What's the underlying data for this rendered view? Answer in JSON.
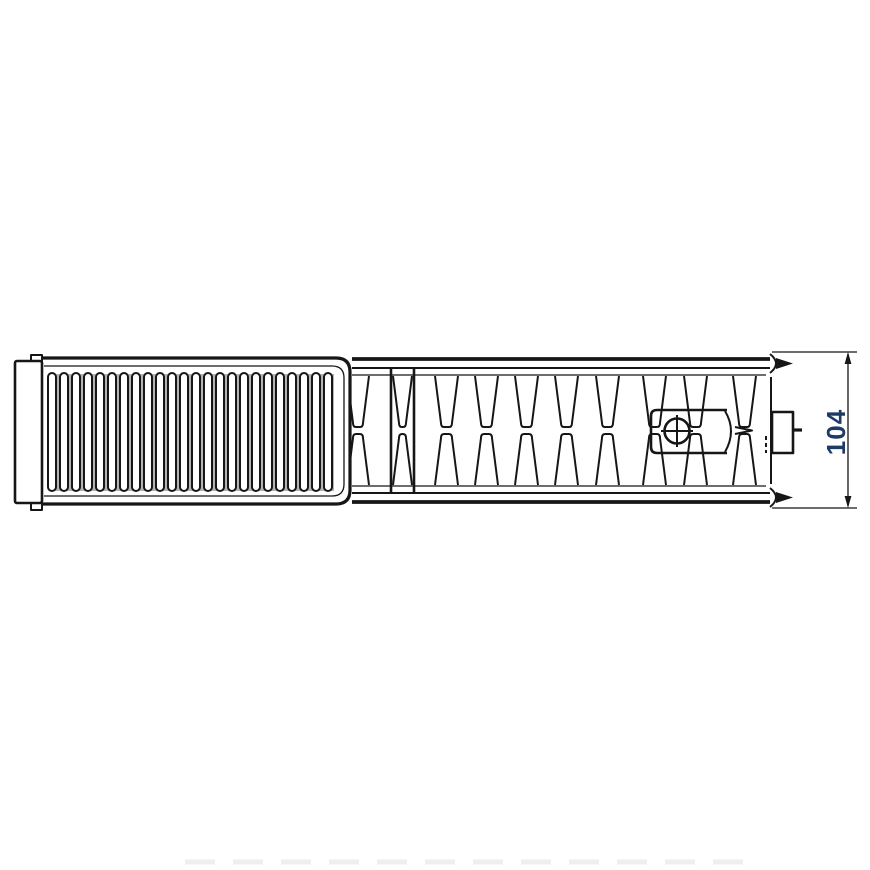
{
  "dimension": {
    "value": "104",
    "color": "#1e3a66"
  },
  "drawing": {
    "stroke_color": "#161616",
    "fin_shade_color": "#b4b4b4",
    "shadow_color": "#efefef",
    "fins": {
      "count": 24,
      "start_x": 48,
      "pitch": 12,
      "width": 8,
      "top": 373,
      "bottom": 491,
      "radius": 4
    },
    "channel_geometry": {
      "top_y": 376,
      "mid_top": 427,
      "mid_bot": 434,
      "bottom_y": 485,
      "inset": 6
    },
    "channels": [
      [
        347,
        369
      ],
      [
        393,
        412
      ],
      [
        435,
        458
      ],
      [
        475,
        498
      ],
      [
        515,
        538
      ],
      [
        555,
        578
      ],
      [
        596,
        619
      ],
      [
        643,
        666
      ],
      [
        684,
        707
      ],
      [
        733,
        756
      ]
    ]
  }
}
